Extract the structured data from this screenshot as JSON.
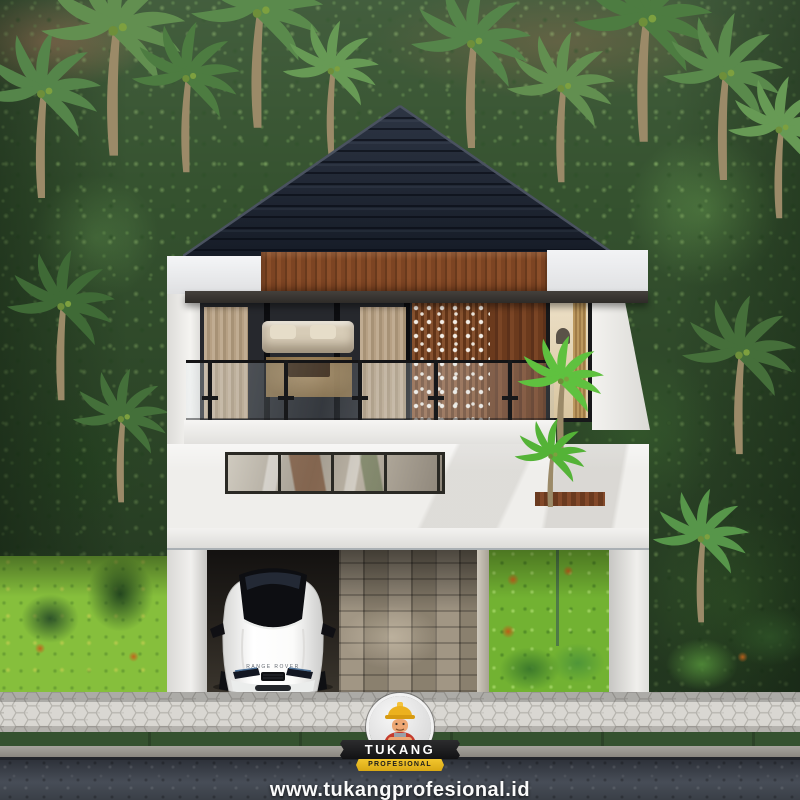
{
  "watermark": {
    "brand": "TUKANG",
    "brand_sub": "PROFESIONAL",
    "website": "www.tukangprofesional.id",
    "tagline": "Make Your Home Excellent",
    "mascot_icon": "builder-mascot-icon"
  },
  "house": {
    "car_brand_text": "RANGE ROVER"
  },
  "colors": {
    "roof": "#1c2330",
    "wood_accent": "#7b4424",
    "wall_white": "#f0efec",
    "grass_bright": "#79b836",
    "jungle_base": "#35522f",
    "sidewalk": "#d8d6d1",
    "road": "#2e323a",
    "brand_black": "#121214",
    "brand_yellow": "#d9a814",
    "brand_red": "#c53b2c"
  }
}
